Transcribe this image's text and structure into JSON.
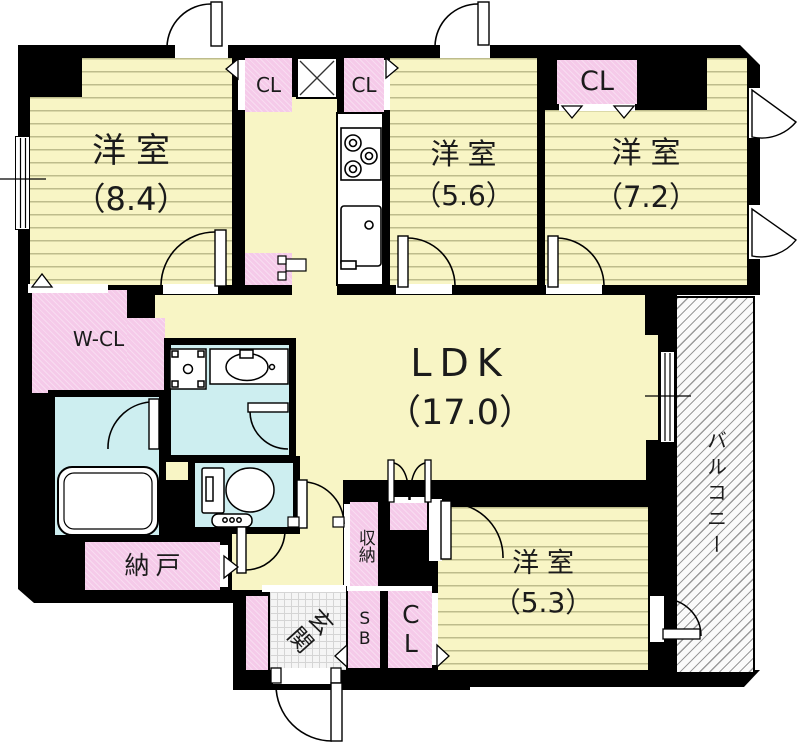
{
  "rooms": {
    "bedroom_84": {
      "name": "洋室",
      "area": "（8.4）"
    },
    "bedroom_56": {
      "name": "洋室",
      "area": "（5.6）"
    },
    "bedroom_72": {
      "name": "洋室",
      "area": "（7.2）"
    },
    "ldk": {
      "name": "LDK",
      "area": "（17.0）"
    },
    "bedroom_53": {
      "name": "洋室",
      "area": "（5.3）"
    },
    "walk_in_closet": {
      "name": "W-CL"
    },
    "closet1": {
      "name": "CL"
    },
    "closet2": {
      "name": "CL"
    },
    "closet3": {
      "name": "CL"
    },
    "closet4": {
      "name": "CL"
    },
    "storage_room": {
      "name": "納戸"
    },
    "storage": {
      "name": "収納"
    },
    "shoe_box": {
      "name": "SB"
    },
    "entrance": {
      "name": "玄関"
    },
    "balcony": {
      "name": "バルコニー"
    }
  },
  "colors": {
    "wall": "#000000",
    "room_fill": "#f8f5c5",
    "closet_fill": "#f5cae9",
    "wet_area_fill": "#cdeef0",
    "balcony_hatch_line": "#9a9a9a"
  }
}
